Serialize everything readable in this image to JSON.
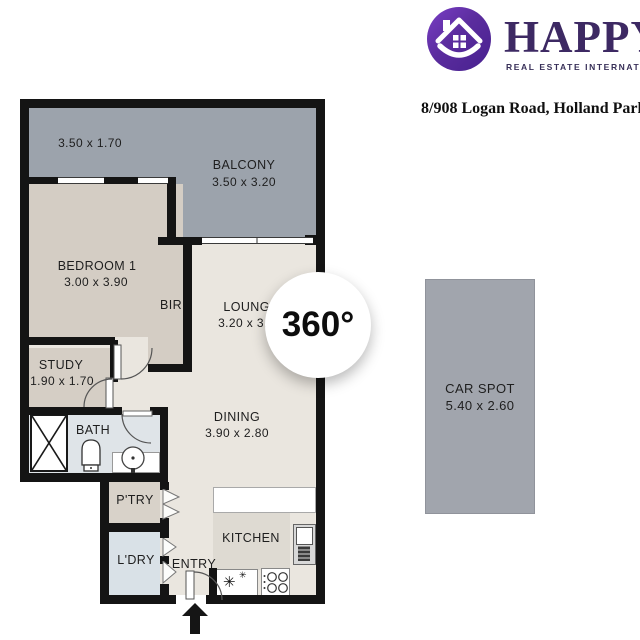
{
  "brand": {
    "name": "HAPPY",
    "tagline": "REAL ESTATE INTERNATIONAL"
  },
  "address": "8/908 Logan Road, Holland Park West",
  "badge_label": "360°",
  "floorplan": {
    "balcony_left": {
      "dims": "3.50 x 1.70"
    },
    "balcony": {
      "name": "BALCONY",
      "dims": "3.50 x 3.20"
    },
    "bedroom1": {
      "name": "BEDROOM 1",
      "dims": "3.00 x 3.90"
    },
    "bir": {
      "name": "BIR"
    },
    "lounge": {
      "name": "LOUNGE",
      "dims": "3.20 x 3.90"
    },
    "study": {
      "name": "STUDY",
      "dims": "1.90 x 1.70"
    },
    "bath": {
      "name": "BATH"
    },
    "dining": {
      "name": "DINING",
      "dims": "3.90 x 2.80"
    },
    "pantry": {
      "name": "P'TRY"
    },
    "laundry": {
      "name": "L'DRY"
    },
    "entry": {
      "name": "ENTRY"
    },
    "kitchen": {
      "name": "KITCHEN"
    }
  },
  "car_spot": {
    "name": "CAR SPOT",
    "dims": "5.40 x 2.60"
  },
  "colors": {
    "wall": "#141414",
    "balcony_fill": "#9ca3ac",
    "bedroom_fill": "#d4cdc4",
    "living_fill": "#eae6df",
    "bath_fill": "#dfe4e8",
    "laundry_fill": "#d9e1e7",
    "pantry_fill": "#d8d2c9",
    "kitchen_fill": "#dedad2",
    "car_spot_fill": "#a1a5ad",
    "brand_purple": "#5b2d9e",
    "brand_text": "#3d2963"
  }
}
